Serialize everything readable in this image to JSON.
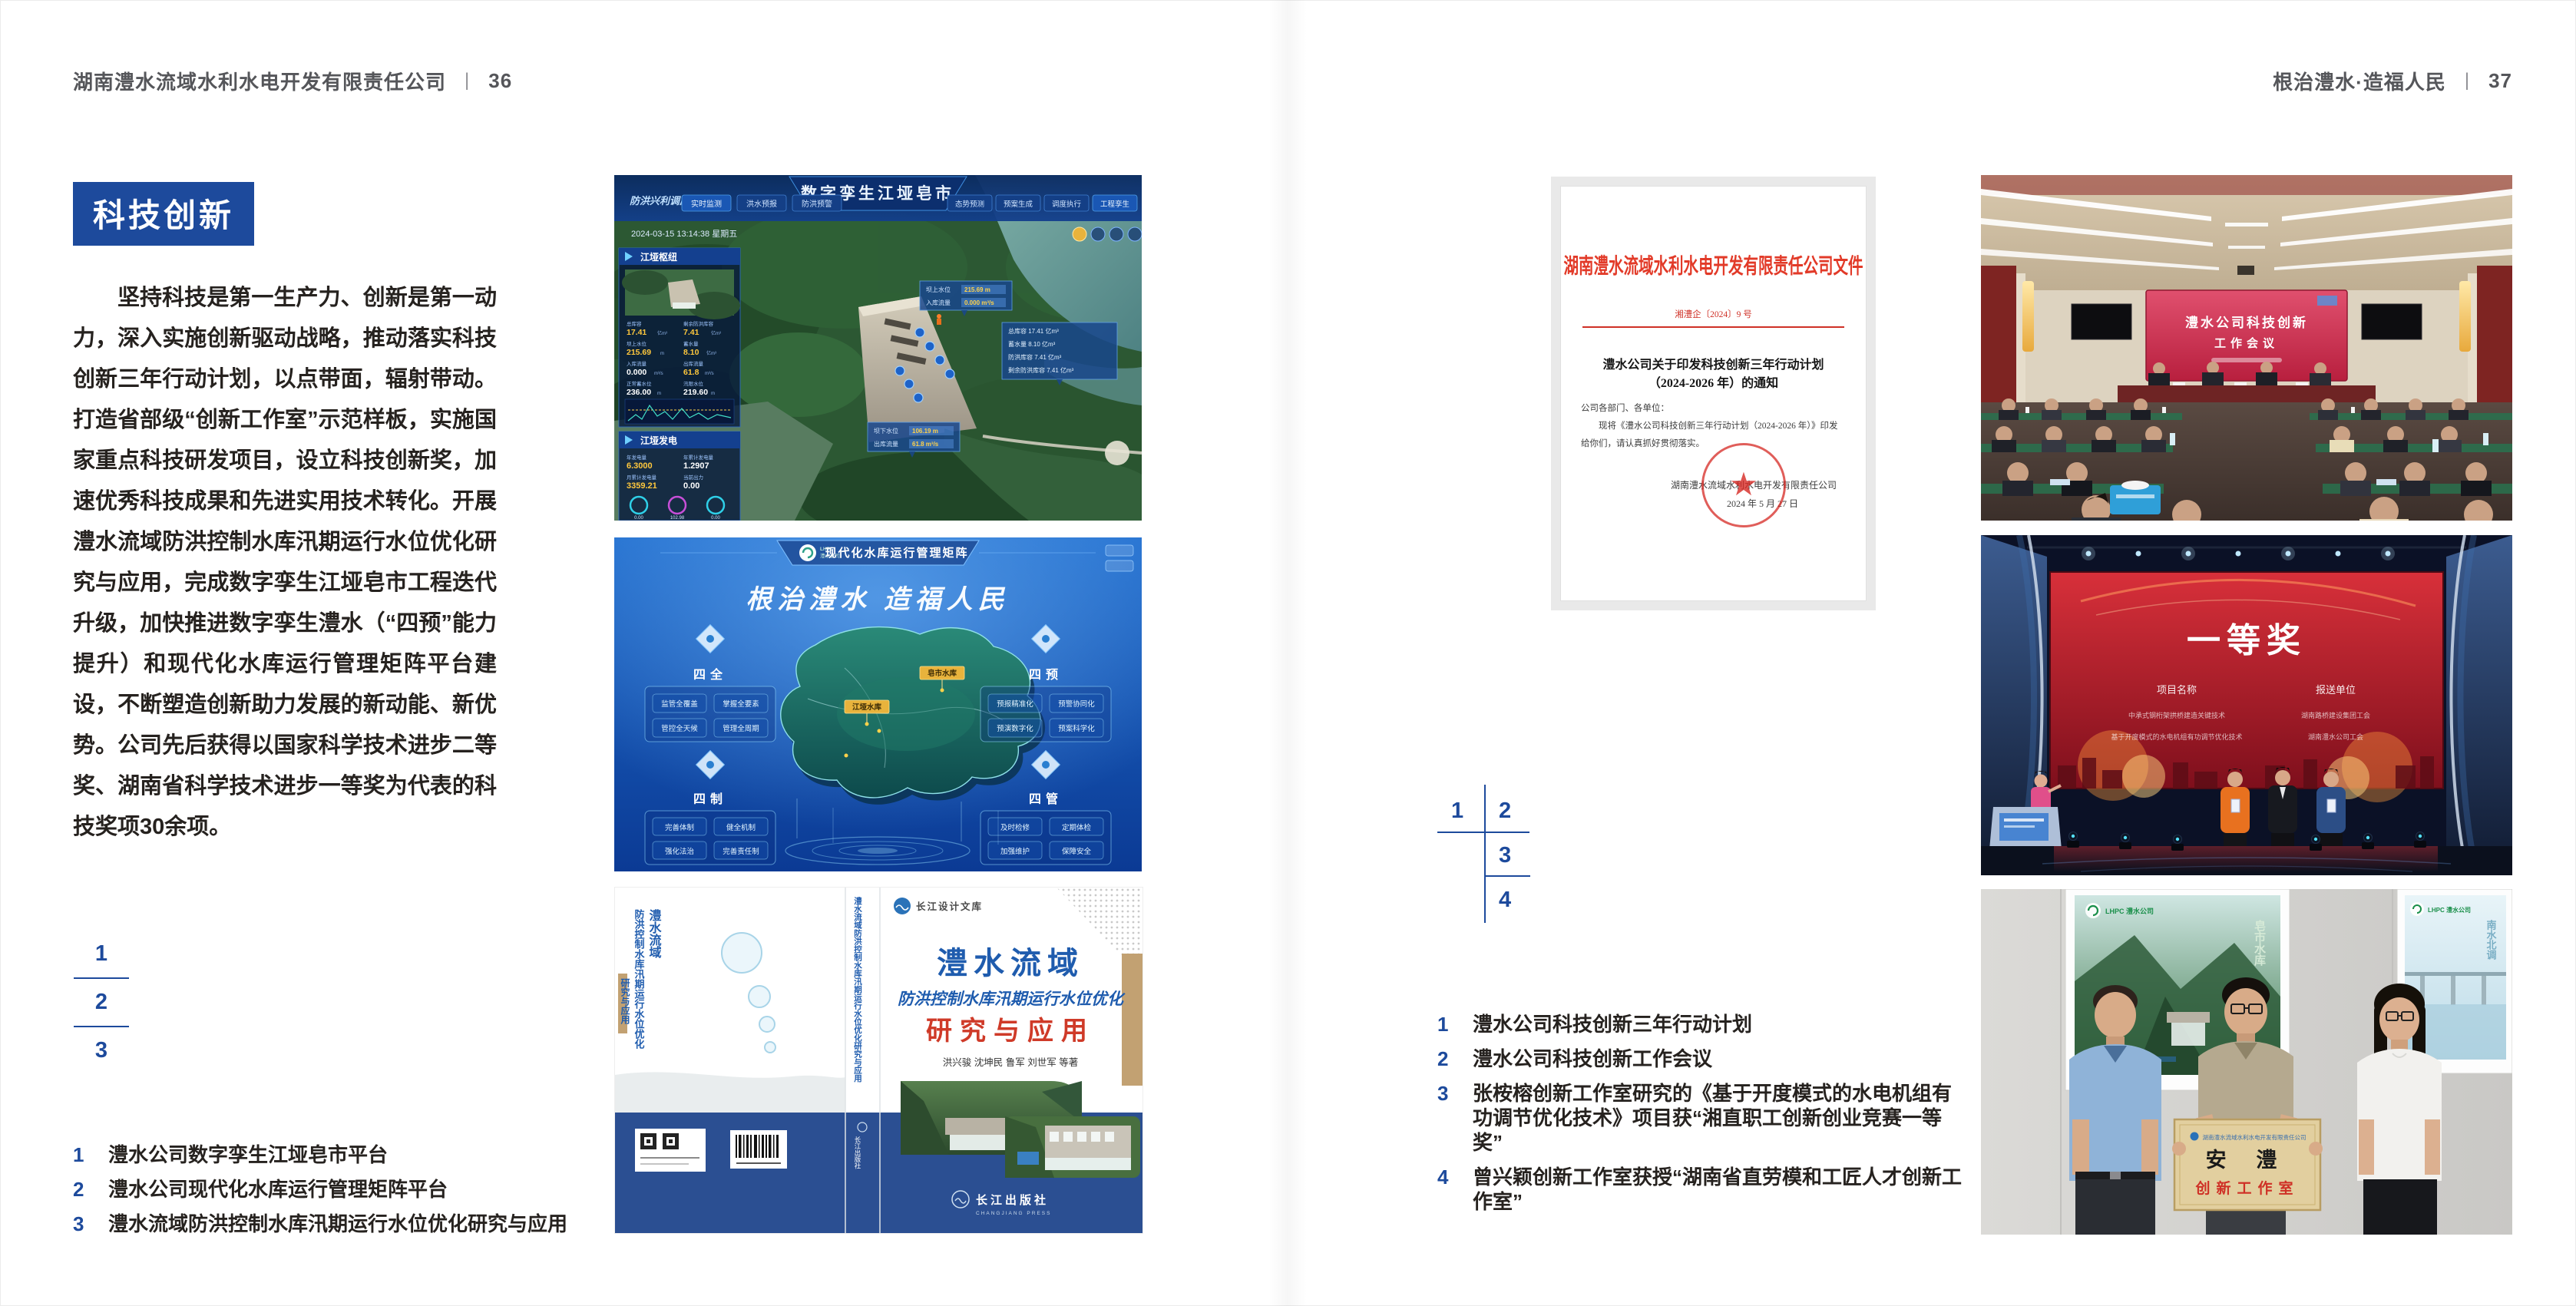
{
  "theme": {
    "accent_blue": "#1d4a9c",
    "header_gray": "#55565a",
    "text_dark": "#26221f",
    "doc_red": "#e23a28",
    "book_blue": "#1f5cae",
    "book_red": "#cf3a28",
    "band_blue": "#2b4f92"
  },
  "page_left": {
    "header": {
      "company": "湖南澧水流域水利水电开发有限责任公司",
      "divider": "|",
      "page_number": "36"
    },
    "section_title": "科技创新",
    "body_text": "坚持科技是第一生产力、创新是第一动力，深入实施创新驱动战略，推动落实科技创新三年行动计划，以点带面，辐射带动。打造省部级“创新工作室”示范样板，实施国家重点科技研发项目，设立科技创新奖，加速优秀科技成果和先进实用技术转化。开展澧水流域防洪控制水库汛期运行水位优化研究与应用，完成数字孪生江垭皂市工程迭代升级，加快推进数字孪生澧水（“四预”能力提升）和现代化水库运行管理矩阵平台建设，不断塑造创新助力发展的新动能、新优势。公司先后获得以国家科学技术进步二等奖、湖南省科学技术进步一等奖为代表的科技奖项30余项。",
    "figure_index": [
      "1",
      "2",
      "3"
    ],
    "captions": [
      {
        "num": "1",
        "text": "澧水公司数字孪生江垭皂市平台"
      },
      {
        "num": "2",
        "text": "澧水公司现代化水库运行管理矩阵平台"
      },
      {
        "num": "3",
        "text": "澧水流域防洪控制水库汛期运行水位优化研究与应用"
      }
    ]
  },
  "page_right": {
    "header": {
      "motto": "根治澧水·造福人民",
      "divider": "|",
      "page_number": "37"
    },
    "figure_index": [
      "1",
      "2",
      "3",
      "4"
    ],
    "captions": [
      {
        "num": "1",
        "text": "澧水公司科技创新三年行动计划"
      },
      {
        "num": "2",
        "text": "澧水公司科技创新工作会议"
      },
      {
        "num": "3",
        "text": "张桉榕创新工作室研究的《基于开度模式的水电机组有功调节优化技术》项目获“湘直职工创新创业竞赛一等奖”"
      },
      {
        "num": "4",
        "text": "曾兴颖创新工作室获授“湖南省直劳模和工匠人才创新工作室”"
      }
    ]
  },
  "dashboard": {
    "corner_label": "防洪兴利调度",
    "title": "数字孪生江垭皂市",
    "tabs_left": [
      "实时监测",
      "洪水预报",
      "防洪预警"
    ],
    "tabs_right": [
      "态势预测",
      "预案生成",
      "调度执行",
      "工程孪生"
    ],
    "datetime": "2024-03-15 13:14:38 星期五",
    "hub_panel_title": "江垭枢纽",
    "power_panel_title": "江垭发电",
    "stats": [
      {
        "label": "总库容",
        "value": "17.41",
        "unit": "亿m³"
      },
      {
        "label": "剩余防洪库容",
        "value": "7.41",
        "unit": "亿m³"
      },
      {
        "label": "坝上水位",
        "value": "215.69",
        "unit": "m"
      },
      {
        "label": "蓄水量",
        "value": "8.10",
        "unit": "亿m³"
      },
      {
        "label": "入库流量",
        "value": "0.000",
        "unit": "m³/s"
      },
      {
        "label": "出库流量",
        "value": "61.8",
        "unit": "m³/s"
      },
      {
        "label": "正常蓄水位",
        "value": "236.00",
        "unit": "m"
      },
      {
        "label": "汛限水位",
        "value": "219.60",
        "unit": "m"
      }
    ],
    "power_stats": [
      {
        "label": "年发电量",
        "value": "6.3000"
      },
      {
        "label": "年累计发电量",
        "value": "1.2907"
      },
      {
        "label": "月累计发电量",
        "value": "3359.21"
      },
      {
        "label": "当前出力",
        "value": "0.00"
      }
    ],
    "power_gauges": [
      "0.00",
      "102.98",
      "0.00"
    ],
    "tooltip1": {
      "l1": "坝上水位",
      "v1": "215.69 m",
      "l2": "入库流量",
      "v2": "0.000 m³/s"
    },
    "tooltip2": {
      "r1": "总库容 17.41 亿m³",
      "r2": "蓄水量 8.10 亿m³",
      "r3": "防洪库容 7.41 亿m³",
      "r4": "剩余防洪库容 7.41 亿m³"
    },
    "tooltip3": {
      "l1": "坝下水位",
      "v1": "106.19 m",
      "l2": "出库流量",
      "v2": "61.8 m³/s"
    }
  },
  "matrix": {
    "logo_line1": "LHPC",
    "logo_line2": "澧水公司",
    "title": "现代化水库运行管理矩阵",
    "slogan": "根治澧水  造福人民",
    "groups": [
      {
        "name": "四全",
        "items": [
          "监管全覆盖",
          "掌握全要素",
          "管控全天候",
          "管理全周期"
        ]
      },
      {
        "name": "四预",
        "items": [
          "预报精准化",
          "预警协同化",
          "预演数字化",
          "预案科学化"
        ]
      },
      {
        "name": "四制",
        "items": [
          "完善体制",
          "健全机制",
          "强化法治",
          "完善责任制"
        ]
      },
      {
        "name": "四管",
        "items": [
          "及时检修",
          "定期体检",
          "加强维护",
          "保障安全"
        ]
      }
    ],
    "map_labels": [
      "皂市水库",
      "江垭水库"
    ]
  },
  "book": {
    "series": "长江设计文库",
    "title1": "澧水流域",
    "title2": "防洪控制水库汛期运行水位优化",
    "title3": "研究与应用",
    "authors": "洪兴骏  沈坤民  鲁军  刘世军  等著",
    "publisher": "长江出版社",
    "publisher_en": "CHANGJIANG PRESS",
    "spine_text": "澧水流域防洪控制水库汛期运行水位优化研究与应用",
    "back_title1": "澧水流域",
    "back_title2": "防洪控制水库汛期运行水位优化",
    "back_title3": "研究与应用"
  },
  "doc": {
    "header": "湖南澧水流域水利水电开发有限责任公司文件",
    "number": "湘澧企〔2024〕9 号",
    "title1": "澧水公司关于印发科技创新三年行动计划",
    "title2": "（2024-2026 年）的通知",
    "salutation": "公司各部门、各单位：",
    "body": "现将《澧水公司科技创新三年行动计划（2024-2026 年）》印发给你们，请认真抓好贯彻落实。",
    "signer": "湖南澧水流域水利水电开发有限责任公司",
    "date": "2024 年 5 月 27 日"
  },
  "meeting": {
    "screen_line1": "澧水公司科技创新",
    "screen_line2": "工作会议"
  },
  "award": {
    "title": "一等奖",
    "col_project": "项目名称",
    "col_unit": "报送单位",
    "rows": [
      {
        "project": "中承式钢桁架拱桥建造关键技术",
        "unit": "湖南路桥建设集团工会"
      },
      {
        "project": "基于开度模式的水电机组有功调节优化技术",
        "unit": "湖南澧水公司工会"
      }
    ]
  },
  "workshop": {
    "poster_left_logo": "LHPC 澧水公司",
    "poster_left_caption": "皂市水库",
    "poster_right_logo": "LHPC 澧水公司",
    "poster_right_caption": "南水北调",
    "plaque_org": "湖南澧水流域水利水电开发有限责任公司",
    "plaque_name": "安  澧",
    "plaque_sub": "创新工作室"
  }
}
